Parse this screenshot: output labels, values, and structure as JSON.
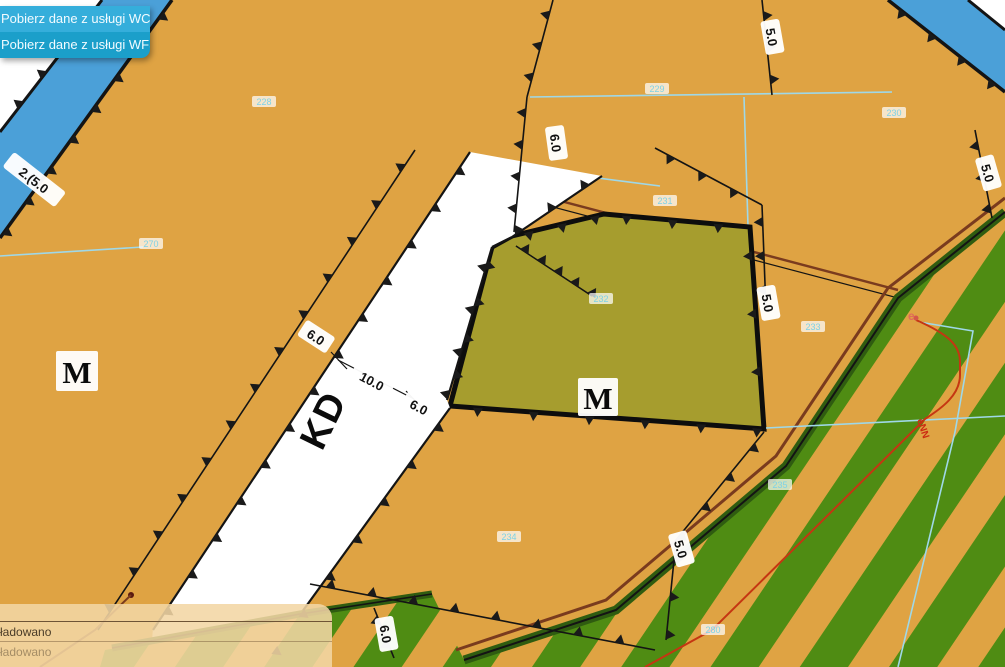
{
  "context_menu": {
    "items": [
      {
        "label": "Pobierz dane z usługi WCS"
      },
      {
        "label": "Pobierz dane z usługi WFS"
      }
    ]
  },
  "status_panel": {
    "rows": [
      {
        "label": "ładowano"
      },
      {
        "label": "ładowano"
      }
    ]
  },
  "map": {
    "zone_labels": [
      {
        "text": "M"
      },
      {
        "text": "M"
      }
    ],
    "road_label": {
      "text": "KD"
    },
    "dimensions": [
      {
        "text": "2.(5.0"
      },
      {
        "text": "6.0"
      },
      {
        "text": "10.0"
      },
      {
        "text": "6.0"
      },
      {
        "text": "6.0"
      },
      {
        "text": "5.0"
      },
      {
        "text": "5.0"
      },
      {
        "text": "5.0"
      },
      {
        "text": "5.0"
      },
      {
        "text": "6.0"
      }
    ],
    "parcels": [
      {
        "number": "228"
      },
      {
        "number": "270"
      },
      {
        "number": "229"
      },
      {
        "number": "230"
      },
      {
        "number": "231"
      },
      {
        "number": "232"
      },
      {
        "number": "233"
      },
      {
        "number": "234"
      },
      {
        "number": "235"
      },
      {
        "number": "280"
      }
    ],
    "markers": {
      "e_point": "e",
      "power_line": "eNN"
    },
    "colors": {
      "orange": "#dfa343",
      "olive": "#a69d2e",
      "road_blue": "#4ba0d8",
      "stripe_green": "#4f8c13",
      "dark_green_edge": "#2f5c10",
      "cyan_line": "#9fd8e8",
      "parcel_label": "#7ed2e6",
      "brown_line": "#7a3b1e",
      "red_line": "#c53612",
      "menu_bg": "#1b9fca",
      "panel_bg": "#f2d6a4"
    }
  }
}
